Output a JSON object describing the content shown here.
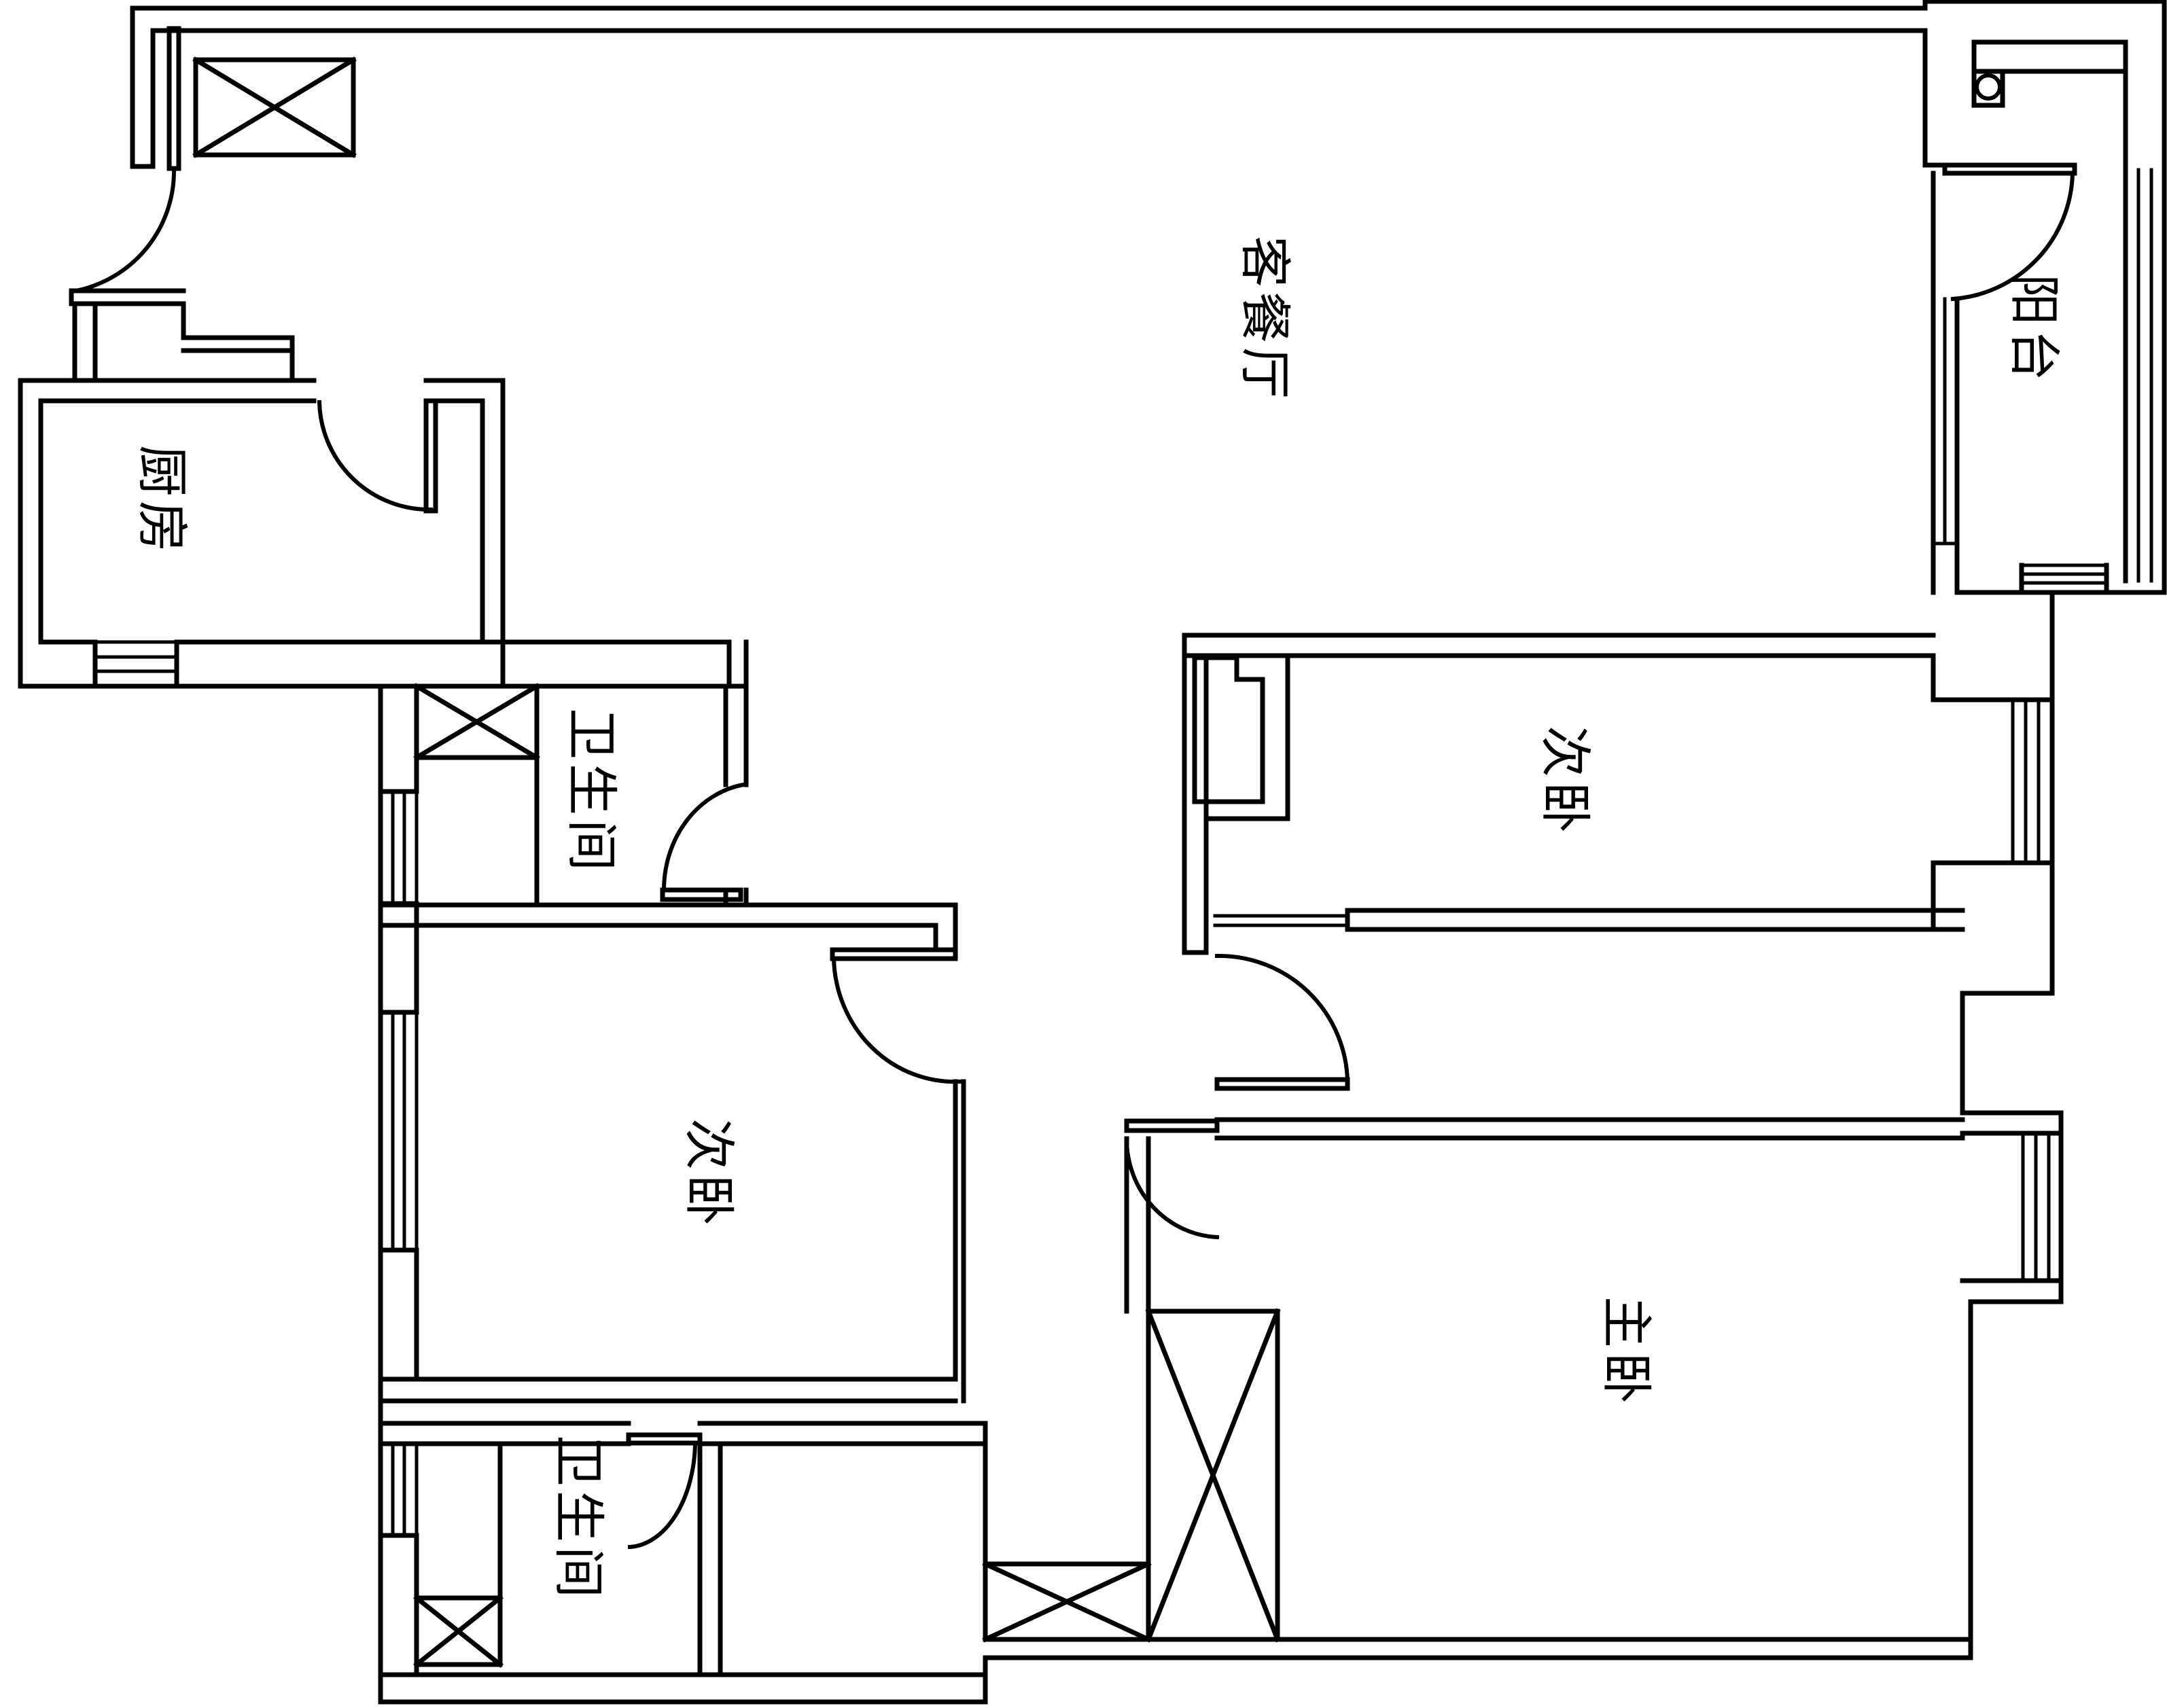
{
  "drawing": {
    "type": "apartment-floor-plan",
    "ink_color": "#000000",
    "background_color": "#ffffff"
  },
  "floor_plan": {
    "rooms": [
      {
        "id": "living-dining",
        "label": "客餐厅"
      },
      {
        "id": "balcony",
        "label": "阳台"
      },
      {
        "id": "kitchen",
        "label": "厨房"
      },
      {
        "id": "bathroom-upper",
        "label": "卫生间"
      },
      {
        "id": "bedroom-right",
        "label": "次卧"
      },
      {
        "id": "bedroom-left",
        "label": "次卧"
      },
      {
        "id": "master-bedroom",
        "label": "主卧"
      },
      {
        "id": "bathroom-lower",
        "label": "卫生间"
      }
    ],
    "icons": {
      "door": "quarter-circle-door-swing-icon",
      "window": "multi-line-window-icon",
      "shaft": "crossed-box-shaft-icon",
      "appliance": "circle-in-box-fixture-icon"
    }
  }
}
